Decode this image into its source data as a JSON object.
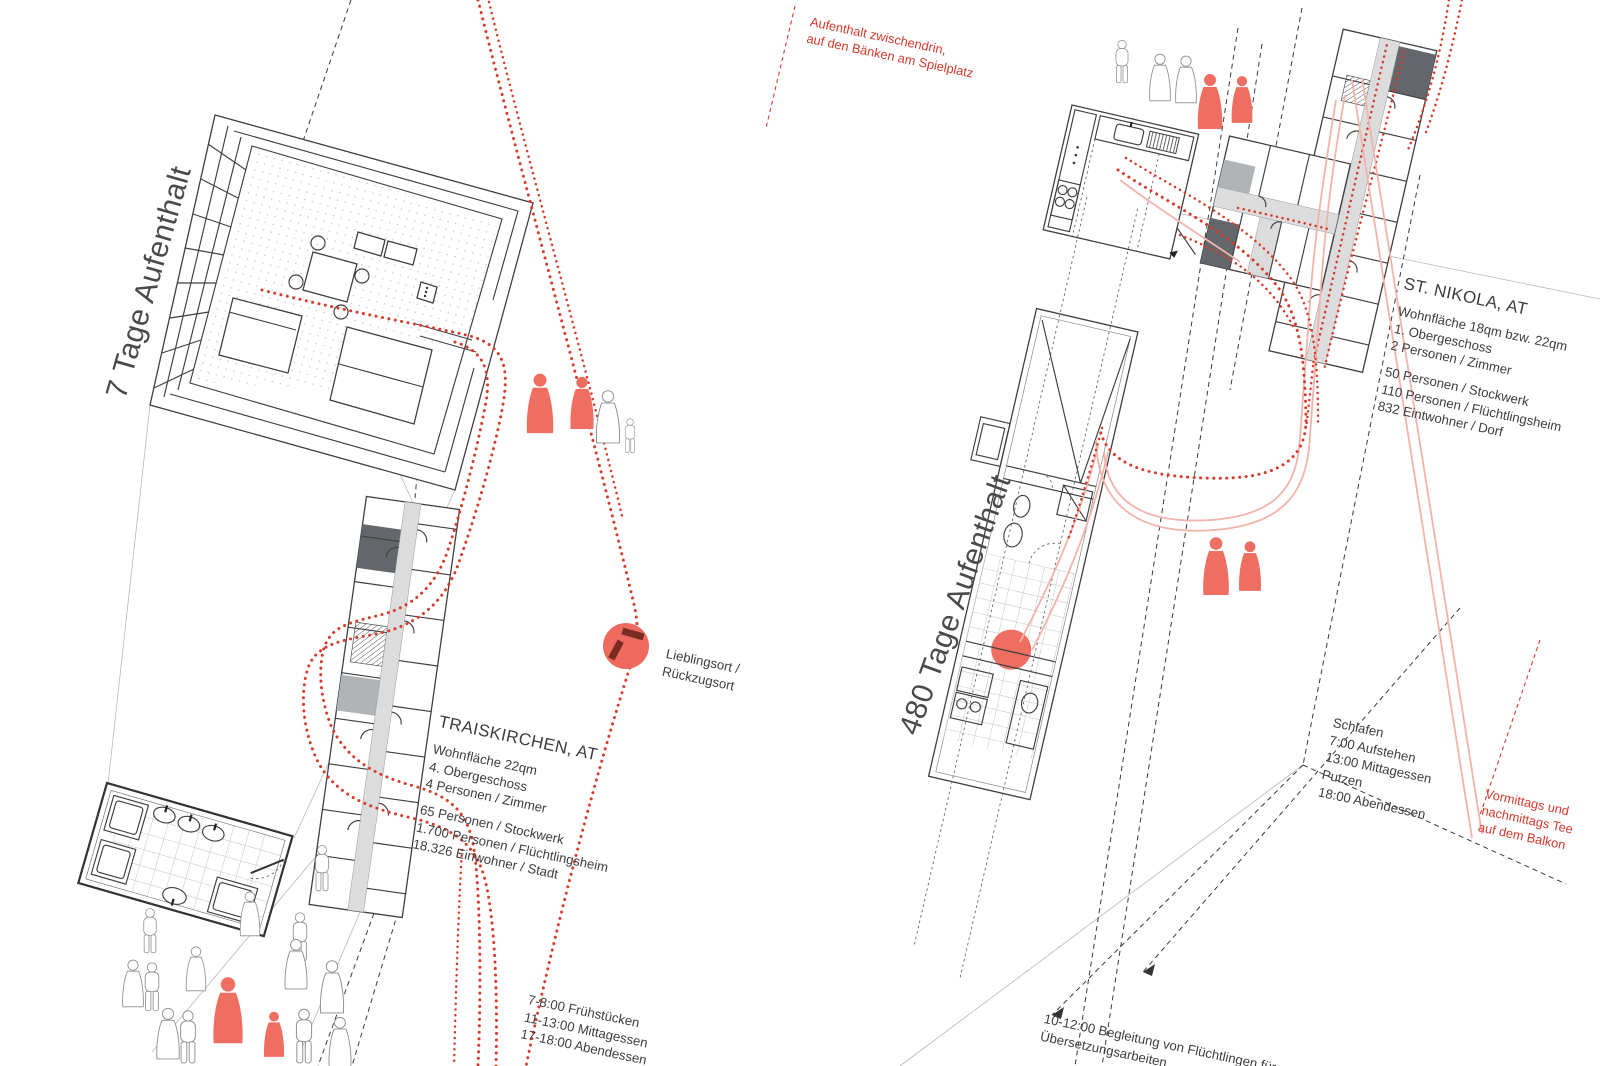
{
  "palette": {
    "route_red": "#d63b2c",
    "figure_red": "#ee6e62",
    "route_pink": "#f2b3ad",
    "ink_gray": "#3d3d3d",
    "label_gray": "#4a4a4a"
  },
  "headers": {
    "left_duration": "7 Tage Aufenthalt",
    "right_duration": "480 Tage Aufenthalt"
  },
  "locations": {
    "traiskirchen": {
      "title": "TRAISKIRCHEN, AT",
      "details": [
        "Wohnfläche 22qm",
        "4. Obergeschoss",
        "4 Personen / Zimmer"
      ],
      "stats": [
        "65 Personen / Stockwerk",
        "1.700 Personen / Flüchtlingsheim",
        "18.326 Einwohner / Stadt"
      ],
      "schedule": [
        "7-8:00 Frühstücken",
        "11-13:00 Mittagessen",
        "17-18:00 Abendessen"
      ]
    },
    "st_nikola": {
      "title": "ST. NIKOLA, AT",
      "details": [
        "Wohnfläche 18qm bzw. 22qm",
        "1. Obergeschoss",
        "2 Personen / Zimmer"
      ],
      "stats": [
        "50 Personen / Stockwerk",
        "110 Personen / Flüchtlingsheim",
        "832 Eintwohner / Dorf"
      ],
      "schedule": [
        "Schlafen",
        "7:00 Aufstehen",
        "13:00 Mittagessen",
        "Putzen",
        "18:00 Abendessen"
      ]
    }
  },
  "notes": {
    "playground": [
      "Aufenthalt zwischendrin,",
      "auf den Bänken am Spielplatz"
    ],
    "favorite_place": [
      "Lieblingsort /",
      "Rückzugsort"
    ],
    "balcony": [
      "Vormittags und",
      "nachmittags Tee",
      "auf dem Balkon"
    ],
    "translation": [
      "10-12:00 Begleitung von Flüchtlingen für",
      "Übersetzungsarbeiten"
    ]
  },
  "figure_groups": {
    "left_room_group": {
      "red": 2,
      "outlined": 2
    },
    "left_crowd": {
      "red": 2,
      "outlined": 13
    },
    "top_right_group": {
      "red": 2,
      "outlined": 3
    },
    "mid_right_pair": {
      "red": 2,
      "outlined": 0
    }
  }
}
